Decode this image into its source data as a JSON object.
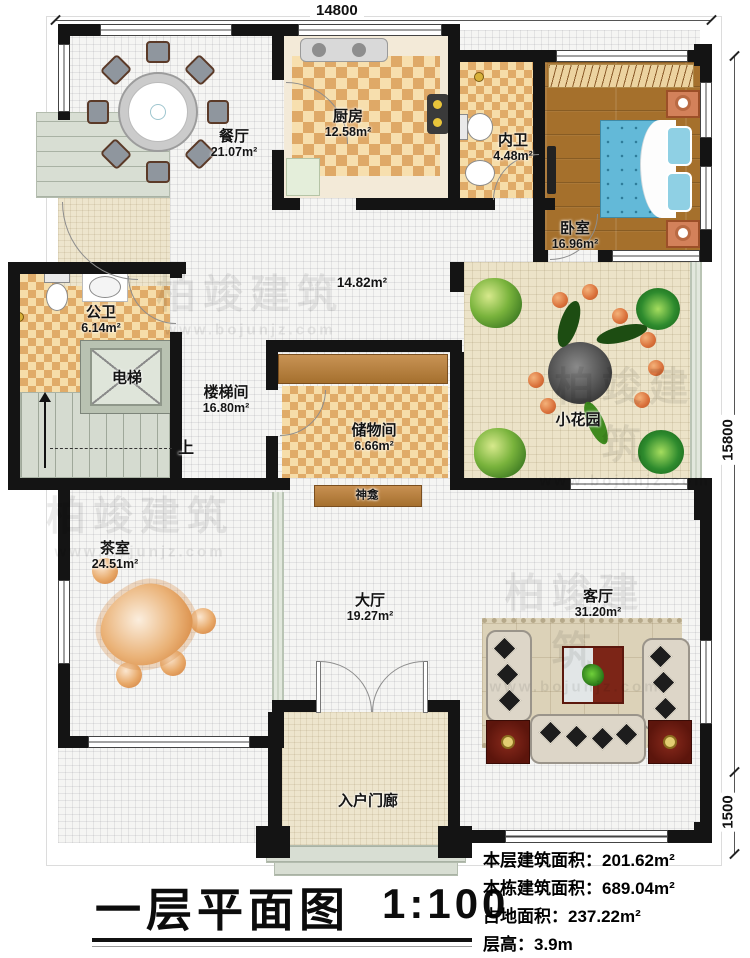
{
  "title_block": {
    "title": "一层平面图",
    "scale": "1:100",
    "stats": [
      {
        "label": "本层建筑面积：",
        "value": "201.62m²"
      },
      {
        "label": "本栋建筑面积：",
        "value": "689.04m²"
      },
      {
        "label": "占地面积：",
        "value": "237.22m²"
      },
      {
        "label": "层高：",
        "value": "3.9m"
      }
    ]
  },
  "dimensions": {
    "top": "14800",
    "right_main": "15800",
    "right_lower": "1500"
  },
  "watermark": {
    "brand": "柏竣建筑",
    "url": "www.bojunjz.com"
  },
  "rooms": {
    "dining": {
      "name": "餐厅",
      "area": "21.07m²"
    },
    "kitchen": {
      "name": "厨房",
      "area": "12.58m²"
    },
    "inner_bath": {
      "name": "内卫",
      "area": "4.48m²"
    },
    "bedroom": {
      "name": "卧室",
      "area": "16.96m²"
    },
    "public_bath": {
      "name": "公卫",
      "area": "6.14m²"
    },
    "elevator": {
      "name": "电梯"
    },
    "stairwell": {
      "name": "楼梯间",
      "area": "16.80m²"
    },
    "corridor": {
      "area": "14.82m²"
    },
    "storage": {
      "name": "储物间",
      "area": "6.66m²"
    },
    "garden": {
      "name": "小花园"
    },
    "shrine": {
      "name": "神龛"
    },
    "tea": {
      "name": "茶室",
      "area": "24.51m²"
    },
    "hall": {
      "name": "大厅",
      "area": "19.27m²"
    },
    "living": {
      "name": "客厅",
      "area": "31.20m²"
    },
    "porch": {
      "name": "入户门廊"
    },
    "stairs_up": {
      "label": "上"
    }
  },
  "colors": {
    "wall": "#141414",
    "checker_dark": "#dfa967",
    "checker_light": "#f7dfae",
    "wood_floor": "#a5702c",
    "bed_blue": "#63b9d8",
    "garden_floor": "#ece3c8",
    "sofa_beige": "#ddd6c8",
    "accent_red": "#7c2517"
  }
}
